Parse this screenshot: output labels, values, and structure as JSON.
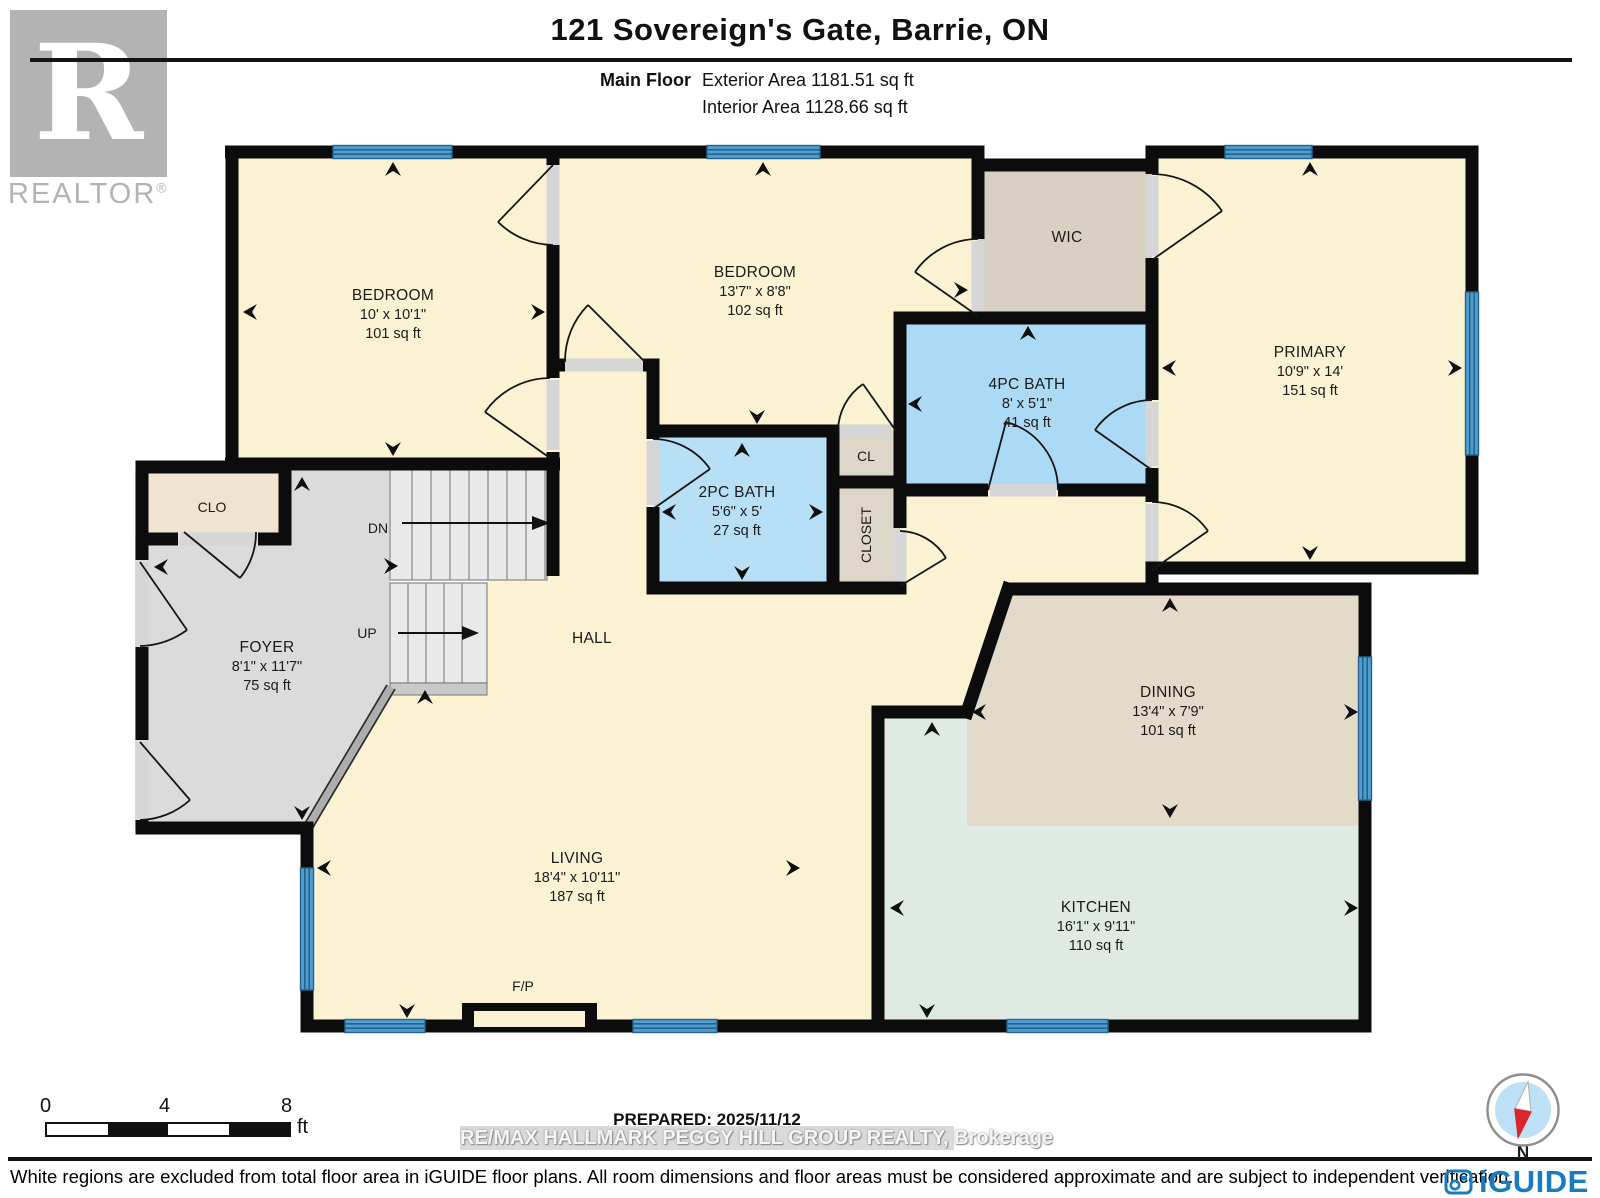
{
  "header": {
    "title": "121 Sovereign's Gate, Barrie, ON",
    "floor_label": "Main Floor",
    "exterior_area": "Exterior Area 1181.51 sq ft",
    "interior_area": "Interior Area 1128.66 sq ft"
  },
  "branding": {
    "realtor_letter": "R",
    "realtor_name": "REALTOR",
    "registered_mark": "®",
    "iguide_name": "iGUIDE"
  },
  "rooms": {
    "bedroom1": {
      "label": "BEDROOM",
      "dims": "10' x 10'1\"",
      "area": "101 sq ft"
    },
    "bedroom2": {
      "label": "BEDROOM",
      "dims": "13'7\" x 8'8\"",
      "area": "102 sq ft"
    },
    "wic": {
      "label": "WIC"
    },
    "primary": {
      "label": "PRIMARY",
      "dims": "10'9\" x 14'",
      "area": "151 sq ft"
    },
    "bath4": {
      "label": "4PC BATH",
      "dims": "8' x 5'1\"",
      "area": "41 sq ft"
    },
    "bath2": {
      "label": "2PC BATH",
      "dims": "5'6\" x 5'",
      "area": "27 sq ft"
    },
    "cl": {
      "label": "CL"
    },
    "closet": {
      "label": "CLOSET"
    },
    "clo": {
      "label": "CLO"
    },
    "foyer": {
      "label": "FOYER",
      "dims": "8'1\" x 11'7\"",
      "area": "75 sq ft"
    },
    "hall": {
      "label": "HALL"
    },
    "dining": {
      "label": "DINING",
      "dims": "13'4\" x 7'9\"",
      "area": "101 sq ft"
    },
    "kitchen": {
      "label": "KITCHEN",
      "dims": "16'1\" x 9'11\"",
      "area": "110 sq ft"
    },
    "living": {
      "label": "LIVING",
      "dims": "18'4\" x 10'11\"",
      "area": "187 sq ft"
    },
    "fireplace": {
      "label": "F/P"
    },
    "stairs": {
      "down": "DN",
      "up": "UP"
    }
  },
  "scale_bar": {
    "tick_0": "0",
    "tick_4": "4",
    "tick_8": "8",
    "unit": "ft"
  },
  "footer": {
    "prepared": "PREPARED: 2025/11/12",
    "watermark": "RE/MAX HALLMARK PEGGY HILL GROUP REALTY, Brokerage",
    "compass_label": "N",
    "disclaimer": "White regions are excluded from total floor area in iGUIDE floor plans. All room dimensions and floor areas must be considered approximate and are subject to independent verification."
  },
  "colors": {
    "room_cream": "#FBF1D3",
    "room_gray": "#DBDBDB",
    "room_tan_wic": "#D8D0C2",
    "room_tan_closet": "#DED6C8",
    "room_tan_clo": "#F0E3CF",
    "room_dining": "#E4DACA",
    "room_kitchen": "#DFEBE2",
    "bath_blue_2pc": "#B7DFF6",
    "bath_blue_4pc": "#ACD9F3",
    "window_blue": "#4E9FD0",
    "wall_black": "#0C0C0C",
    "iguide_blue": "#1A7CC0",
    "compass_red": "#D9252B"
  }
}
